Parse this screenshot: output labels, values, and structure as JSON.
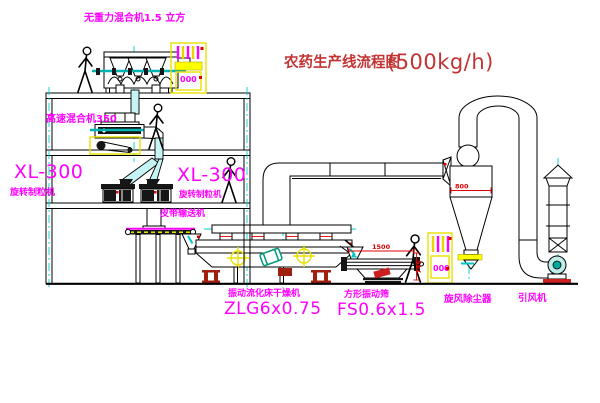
{
  "diagram": {
    "title": {
      "cn": "农药生产线流程图",
      "capacity": "(500kg/h)"
    },
    "labels": {
      "gravity_mixer": "无重力混合机1.5 立方",
      "high_speed_mixer": "高速混合机350",
      "granulator_left_model": "XL-300",
      "granulator_left_name": "旋转制粒机",
      "granulator_right_model": "XL-300",
      "granulator_right_name": "旋转制粒机",
      "belt_conveyor": "皮带输送机",
      "dryer_name": "振动流化床干燥机",
      "dryer_model": "ZLG6x0.75",
      "sieve_name": "方形振动筛",
      "sieve_model": "FS0.6x1.5",
      "cyclone_name": "旋风除尘器",
      "fan_name": "引风机"
    },
    "dimensions": {
      "sieve_length": "1500",
      "sieve_height": "745",
      "cyclone_width": "800"
    },
    "cabinet_display": "000",
    "colors": {
      "line": "#000000",
      "centerline": "#00cfcf",
      "pipe_fill": "#c6f3f3",
      "label": "#ff00ff",
      "dimension": "#e00000",
      "title": "#c23333",
      "cabinet": "#ffff00",
      "support": "#a02010",
      "drum": "#009977",
      "fan": "#00a89d"
    }
  }
}
